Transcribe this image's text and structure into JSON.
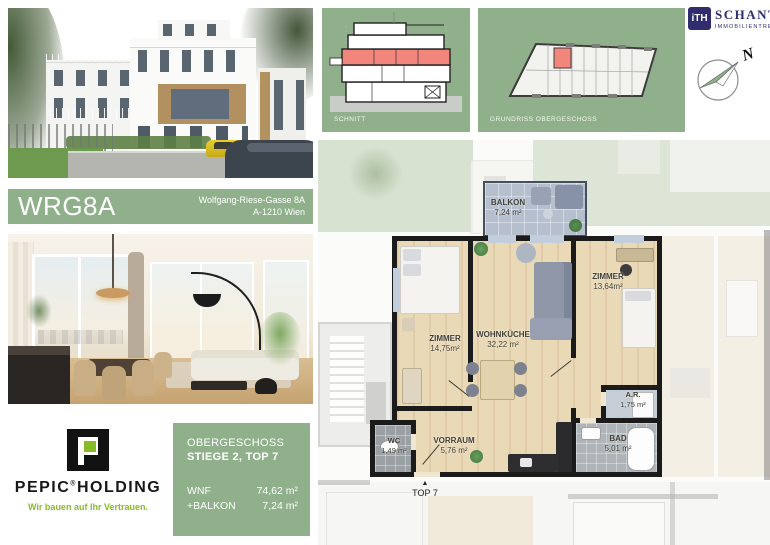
{
  "header": {
    "project_code": "WRG8A",
    "address_line1": "Wolfgang-Riese-Gasse 8A",
    "address_line2": "A-1210 Wien"
  },
  "panels": {
    "schnitt": {
      "caption": "SCHNITT"
    },
    "grundriss": {
      "caption": "GRUNDRISS OBERGESCHOSS"
    }
  },
  "broker": {
    "logo_monogram": "iTH",
    "name": "SCHANTL",
    "tagline": "IMMOBILIENTREUHAND"
  },
  "compass": {
    "north": "N"
  },
  "developer": {
    "brand": "PEPIC",
    "registered_mark": "®",
    "brand2": "HOLDING",
    "slogan": "Wir bauen auf Ihr Vertrauen."
  },
  "unit_info": {
    "floor": "OBERGESCHOSS",
    "unit": "STIEGE 2, TOP 7",
    "metrics": [
      {
        "label": "WNF",
        "value": "74,62 m²"
      },
      {
        "label": "+BALKON",
        "value": "7,24 m²"
      }
    ]
  },
  "floorplan": {
    "entry_marker": "▲",
    "entry_label": "TOP 7",
    "rooms": [
      {
        "name": "BALKON",
        "area": "7,24 m²"
      },
      {
        "name": "ZIMMER",
        "area": "14,75m²"
      },
      {
        "name": "WOHNKÜCHE",
        "area": "32,22 m²"
      },
      {
        "name": "ZIMMER",
        "area": "13,64m²"
      },
      {
        "name": "A.R.",
        "area": "1,75 m²"
      },
      {
        "name": "BAD",
        "area": "5,01 m²"
      },
      {
        "name": "WC",
        "area": "1,49 m²"
      },
      {
        "name": "VORRAUM",
        "area": "5,76 m²"
      }
    ]
  },
  "colors": {
    "panel_green": "#8FB08B",
    "highlight_red": "#F2867D",
    "pepic_green": "#87BC27",
    "ith_navy": "#2F2D6E",
    "wood_floor": "#EAD9B6",
    "wall_black": "#1B1B1B",
    "balcony_gray": "#B5BFCE"
  }
}
